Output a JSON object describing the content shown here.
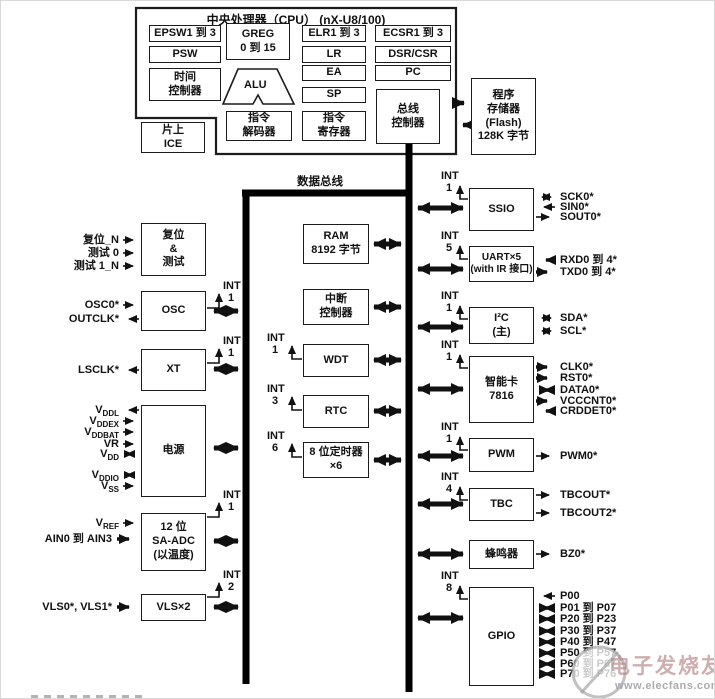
{
  "cpu": {
    "title": "中央处理器（CPU） (nX-U8/100)",
    "epsw": "EPSW1 到 3",
    "psw": "PSW",
    "time_ctrl": "时间\n控制器",
    "greg": "GREG\n0 到 15",
    "alu": "ALU",
    "elr": "ELR1 到 3",
    "lr": "LR",
    "ea": "EA",
    "sp": "SP",
    "ecsr": "ECSR1 到 3",
    "dsr_csr": "DSR/CSR",
    "pc": "PC",
    "inst_dec": "指令\n解码器",
    "inst_reg": "指令\n寄存器",
    "bus_ctrl": "总线\n控制器",
    "ice": "片上\nICE"
  },
  "memory": {
    "flash": "程序\n存储器\n(Flash)\n128K 字节",
    "ram": "RAM\n8192 字节"
  },
  "bus": {
    "data_bus": "数据总线"
  },
  "blocks": {
    "reset": "复位\n&\n测试",
    "osc": "OSC",
    "xt": "XT",
    "power": "电源",
    "adc": "12 位\nSA-ADC\n(以温度)",
    "vls": "VLS×2",
    "intc": "中断\n控制器",
    "wdt": "WDT",
    "rtc": "RTC",
    "timer8": "8 位定时器\n×6",
    "ssio": "SSIO",
    "uart": "UART×5\n(with IR 接口)",
    "i2c": "I²C\n(主)",
    "smartcard": "智能卡\n7816",
    "pwm": "PWM",
    "tbc": "TBC",
    "buzzer": "蜂鸣器",
    "gpio": "GPIO"
  },
  "int_label": "INT",
  "ints": {
    "osc": "1",
    "xt": "1",
    "adc": "1",
    "vls": "2",
    "wdt": "1",
    "rtc": "3",
    "timer8": "6",
    "ssio": "1",
    "uart": "5",
    "i2c": "1",
    "smartcard": "1",
    "pwm": "1",
    "tbc": "4",
    "gpio": "8"
  },
  "left_signals": {
    "reset_n": "复位_N",
    "test0": "测试 0",
    "test1_n": "测试 1_N",
    "osc0": "OSC0*",
    "outclk": "OUTCLK*",
    "lsclk": "LSCLK*",
    "ain": "AIN0 到 AIN3",
    "vls_in": "VLS0*, VLS1*"
  },
  "power_pins": [
    {
      "base": "V",
      "sub": "DDL"
    },
    {
      "base": "V",
      "sub": "DDEX"
    },
    {
      "base": "V",
      "sub": "DDBAT"
    },
    {
      "base": "VR",
      "sub": ""
    },
    {
      "base": "V",
      "sub": "DD"
    },
    {
      "base": "V",
      "sub": "DDIO"
    },
    {
      "base": "V",
      "sub": "SS"
    }
  ],
  "vref": {
    "base": "V",
    "sub": "REF"
  },
  "right_signals": {
    "ssio": [
      "SCK0*",
      "SIN0*",
      "SOUT0*"
    ],
    "uart": [
      "RXD0 到 4*",
      "TXD0 到 4*"
    ],
    "i2c": [
      "SDA*",
      "SCL*"
    ],
    "smartcard": [
      "CLK0*",
      "RST0*",
      "DATA0*",
      "VCCCNT0*",
      "CRDDET0*"
    ],
    "pwm": [
      "PWM0*"
    ],
    "tbc": [
      "TBCOUT*",
      "TBCOUT2*"
    ],
    "buzzer": [
      "BZ0*"
    ],
    "gpio": [
      "P00",
      "P01 到 P07",
      "P20 到 P23",
      "P30 到 P37",
      "P40 到 P47",
      "P50 到 P57",
      "P60 到 P67",
      "P70 到 P76"
    ]
  },
  "watermark": {
    "title": "电子发烧友",
    "url": "www.elecfans.com"
  }
}
